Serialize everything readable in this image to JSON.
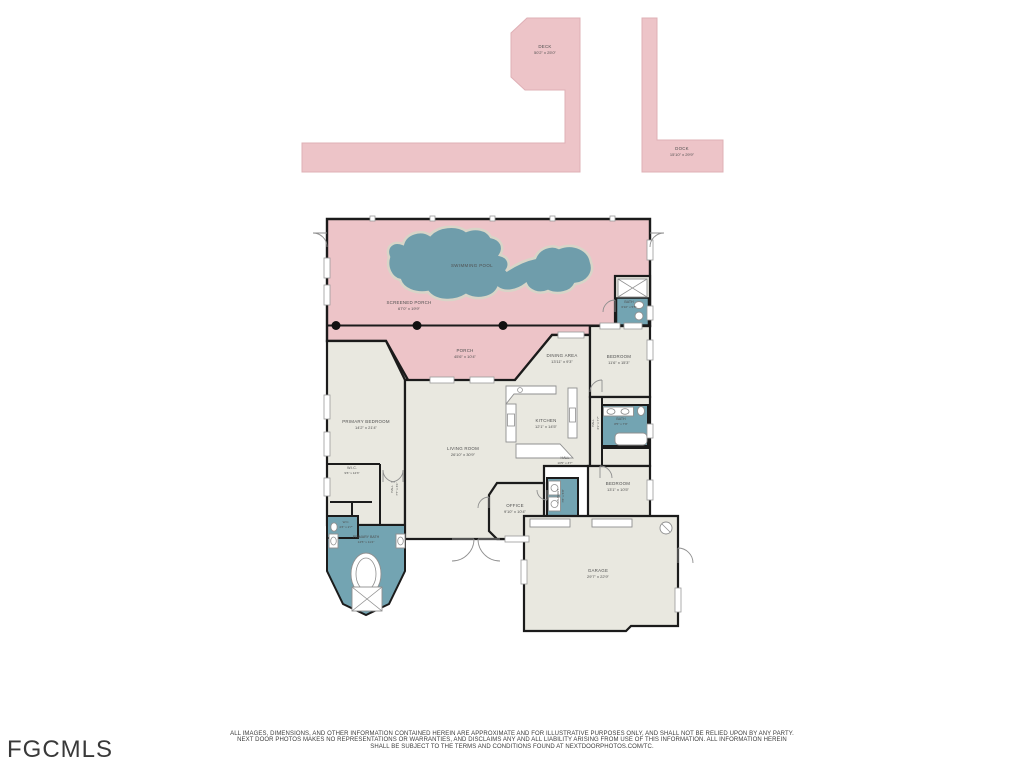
{
  "page": {
    "width": 1024,
    "height": 768,
    "background": "#ffffff"
  },
  "branding": {
    "mls_logo": "FGCMLS"
  },
  "disclaimer": {
    "line1": "ALL IMAGES, DIMENSIONS, AND OTHER INFORMATION CONTAINED HEREIN ARE APPROXIMATE AND FOR ILLUSTRATIVE PURPOSES ONLY, AND SHALL NOT BE RELIED UPON BY ANY PARTY.",
    "line2": "NEXT DOOR PHOTOS MAKES NO REPRESENTATIONS OR WARRANTIES, AND DISCLAIMS ANY AND ALL LIABILITY ARISING FROM USE OF THIS INFORMATION. ALL INFORMATION HEREIN",
    "line3": "SHALL BE SUBJECT TO THE TERMS AND CONDITIONS FOUND AT NEXTDOORPHOTOS.COM/TC."
  },
  "colors": {
    "porch_pink": "#edc4c8",
    "pool_teal": "#6f9dab",
    "bath_teal": "#73a4b2",
    "room_beige": "#e9e8e0",
    "wall_black": "#1b1b1b",
    "label_gray": "#4f4f4f"
  },
  "rooms": {
    "deck": {
      "name": "DECK",
      "dims": "50'2\" x 25'0\""
    },
    "dock": {
      "name": "DOCK",
      "dims": "15'10\" x 29'9\""
    },
    "swimming_pool": {
      "name": "SWIMMING POOL"
    },
    "screened_porch": {
      "name": "SCREENED PORCH",
      "dims": "67'0\" x 19'9\""
    },
    "porch": {
      "name": "PORCH",
      "dims": "45'6\" x 10'4\""
    },
    "pool_bath": {
      "name": "BATH",
      "dims": "6'10\" x 5'5\""
    },
    "bedroom_right_top": {
      "name": "BEDROOM",
      "dims": "11'6\" x 15'3\""
    },
    "dining_area": {
      "name": "DINING AREA",
      "dims": "13'11\" x 9'3\""
    },
    "primary_bedroom": {
      "name": "PRIMARY BEDROOM",
      "dims": "14'2\" x 21'4\""
    },
    "living_room": {
      "name": "LIVING ROOM",
      "dims": "26'10\" x 30'9\""
    },
    "kitchen": {
      "name": "KITCHEN",
      "dims": "12'1\" x 14'5\""
    },
    "hall_vertical": {
      "name": "HALL",
      "dims": "3'1\" x 7'7\""
    },
    "bath_center": {
      "name": "BATH",
      "dims": "8'5\" x 7'9\""
    },
    "hall_horizontal": {
      "name": "HALL",
      "dims": "10'5\" x 3'7\""
    },
    "hall_primary": {
      "name": "HALL",
      "dims": "7'7\" x 3'1\""
    },
    "wic": {
      "name": "W.I.C.",
      "dims": "9'6\" x 12'3\""
    },
    "wc": {
      "name": "W.C.",
      "dims": "4'3\" x 2'7\""
    },
    "primary_bath": {
      "name": "PRIMARY BATH",
      "dims": "14'5\" x 11'4\""
    },
    "bedroom_right_bottom": {
      "name": "BEDROOM",
      "dims": "13'1\" x 10'5\""
    },
    "office": {
      "name": "OFFICE",
      "dims": "9'10\" x 10'4\""
    },
    "laundry": {
      "name": "LAUNDRY",
      "dims": "7'8\" x 5'8\""
    },
    "garage": {
      "name": "GARAGE",
      "dims": "29'7\" x 22'9\""
    }
  }
}
